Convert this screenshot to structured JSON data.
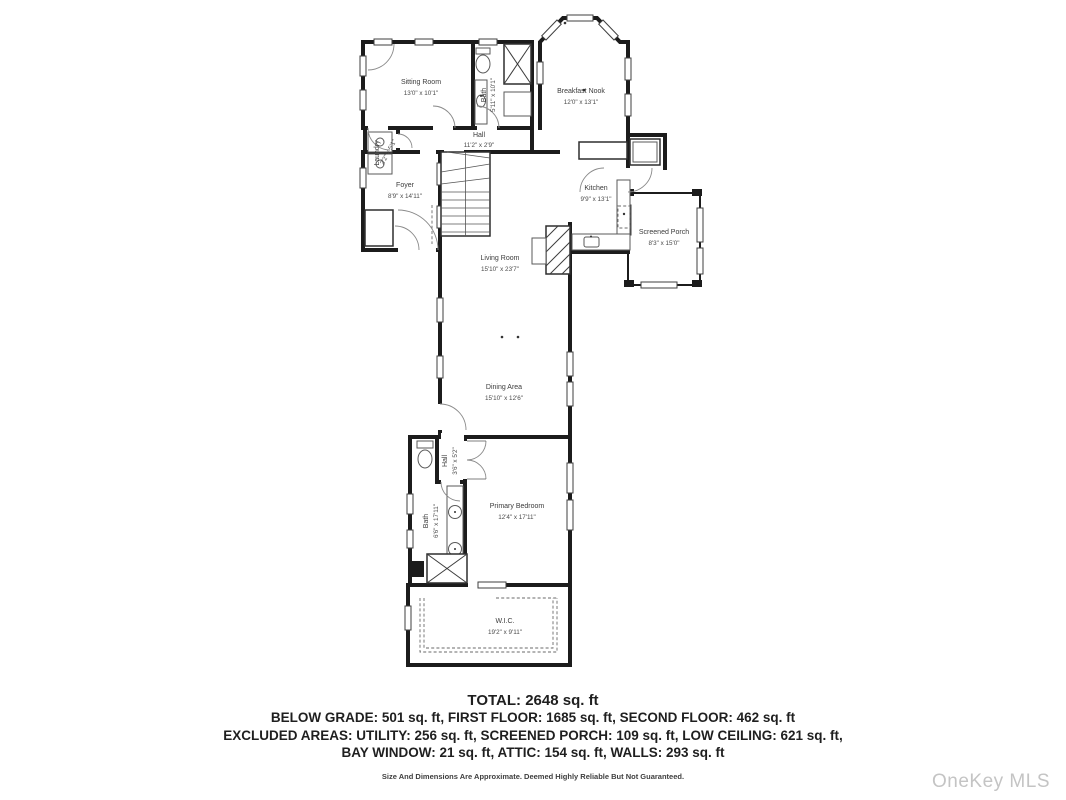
{
  "rooms": [
    {
      "name": "Sitting Room",
      "dims": "13'0\" x 10'1\""
    },
    {
      "name": "Bath",
      "dims": "5'11\" x 10'1\""
    },
    {
      "name": "Breakfast Nook",
      "dims": "12'0\" x 13'1\""
    },
    {
      "name": "Hall",
      "dims": "11'2\" x 2'9\""
    },
    {
      "name": "Laundry",
      "dims": "2'2\" x 5'1\""
    },
    {
      "name": "Foyer",
      "dims": "8'9\" x 14'11\""
    },
    {
      "name": "Kitchen",
      "dims": "9'9\" x 13'1\""
    },
    {
      "name": "Screened Porch",
      "dims": "8'3\" x 15'0\""
    },
    {
      "name": "Living Room",
      "dims": "15'10\" x 23'7\""
    },
    {
      "name": "Dining Area",
      "dims": "15'10\" x 12'6\""
    },
    {
      "name": "Hall",
      "dims": "3'6\" x 5'2\""
    },
    {
      "name": "Bath",
      "dims": "6'6\" x 17'11\""
    },
    {
      "name": "Primary Bedroom",
      "dims": "12'4\" x 17'11\""
    },
    {
      "name": "W.I.C.",
      "dims": "19'2\" x 9'11\""
    }
  ],
  "summary": {
    "total": "TOTAL: 2648 sq. ft",
    "line2": "BELOW GRADE: 501 sq. ft, FIRST FLOOR: 1685 sq. ft, SECOND FLOOR: 462 sq. ft",
    "line3": "EXCLUDED AREAS: UTILITY: 256 sq. ft, SCREENED PORCH: 109 sq. ft, LOW CEILING: 621 sq. ft,",
    "line4": "BAY WINDOW: 21 sq. ft, ATTIC: 154 sq. ft, WALLS: 293 sq. ft",
    "disclaimer": "Size And Dimensions Are Approximate. Deemed Highly Reliable But Not Guaranteed."
  },
  "watermark": "OneKey MLS",
  "colors": {
    "wall": "#1c1c1c",
    "label": "#3b3b3b",
    "watermark": "#c4c4c4",
    "background": "#ffffff"
  }
}
